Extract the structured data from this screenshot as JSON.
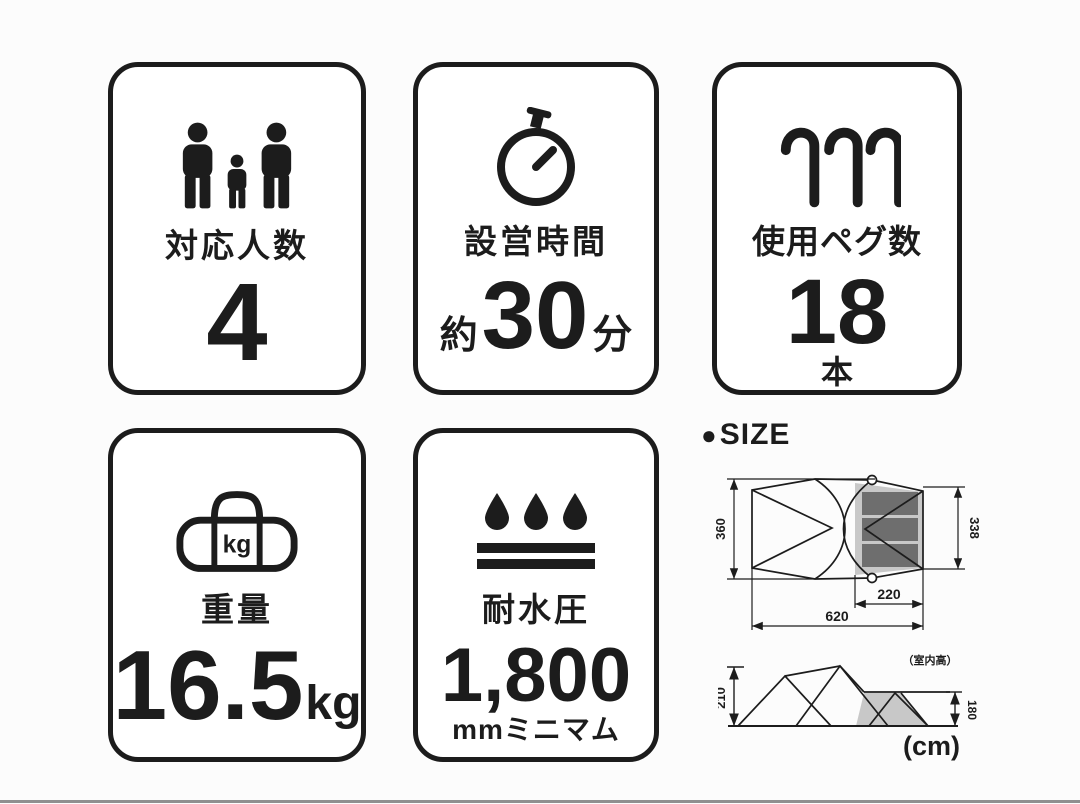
{
  "palette": {
    "ink": "#1c1c1c",
    "background": "#fcfcfc",
    "diagram_gray_light": "#c8c8c8",
    "diagram_gray_dark": "#6e6e6e",
    "bottom_bar": "#8f8f8f"
  },
  "cards": {
    "capacity": {
      "label": "対応人数",
      "value": "4"
    },
    "setup_time": {
      "label": "設営時間",
      "prefix": "約",
      "value": "30",
      "suffix": "分"
    },
    "pegs": {
      "label": "使用ペグ数",
      "value": "18",
      "unit": "本"
    },
    "weight": {
      "label": "重量",
      "value": "16.5",
      "unit": "kg",
      "bag_badge": "kg"
    },
    "waterproof": {
      "label": "耐水圧",
      "value": "1,800",
      "unit": "mmミニマム"
    }
  },
  "size_section": {
    "bullet": "●",
    "heading": "SIZE",
    "unit_note": "(cm)",
    "top_view": {
      "depth_left": "360",
      "depth_right": "338",
      "inner_width": "220",
      "total_width": "620"
    },
    "side_view": {
      "height_left": "210",
      "height_right": "180",
      "interior_note": "（室内高）"
    }
  }
}
